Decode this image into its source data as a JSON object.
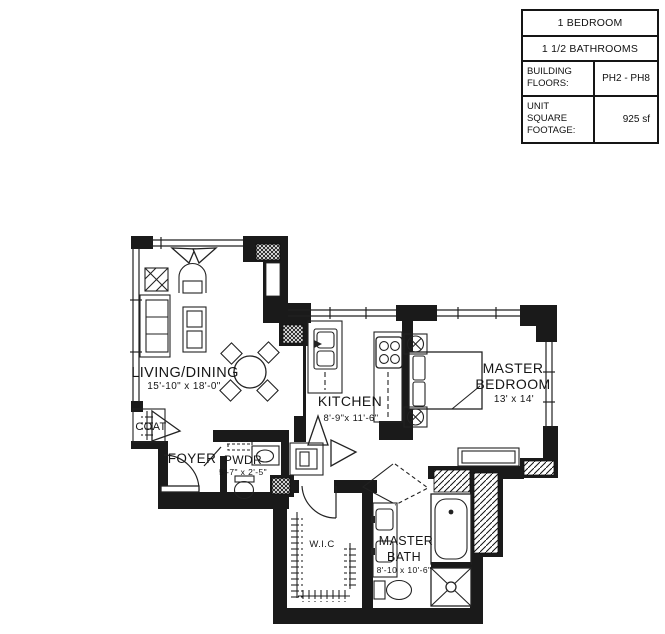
{
  "title_block": {
    "bedroom": "1 BEDROOM",
    "bathrooms": "1 1/2 BATHROOMS",
    "building_floors": {
      "label_line1": "BUILDING",
      "label_line2": "FLOORS:",
      "value": "PH2 - PH8"
    },
    "unit_footage": {
      "label_line1": "UNIT SQUARE",
      "label_line2": "FOOTAGE:",
      "value": "925 sf"
    }
  },
  "rooms": {
    "living_dining": {
      "name": "LIVING/DINING",
      "dims": "15'-10\" x 18'-0\""
    },
    "kitchen": {
      "name": "KITCHEN",
      "dims": "8'-9\"x 11'-6\""
    },
    "master_bedroom": {
      "name_line1": "MASTER",
      "name_line2": "BEDROOM",
      "dims": "13' x 14'"
    },
    "coat": {
      "name": "COAT"
    },
    "foyer": {
      "name": "FOYER"
    },
    "powder_room": {
      "name": "PWDR",
      "dims": "5'-7\" x 2'-5\""
    },
    "walk_in_closet": {
      "name": "W.I.C"
    },
    "master_bath": {
      "name_line1": "MASTER",
      "name_line2": "BATH",
      "dims": "8'-10 x 10'-6\""
    }
  },
  "colors": {
    "wall": "#1a1a1a",
    "line": "#222222",
    "background": "#ffffff"
  }
}
